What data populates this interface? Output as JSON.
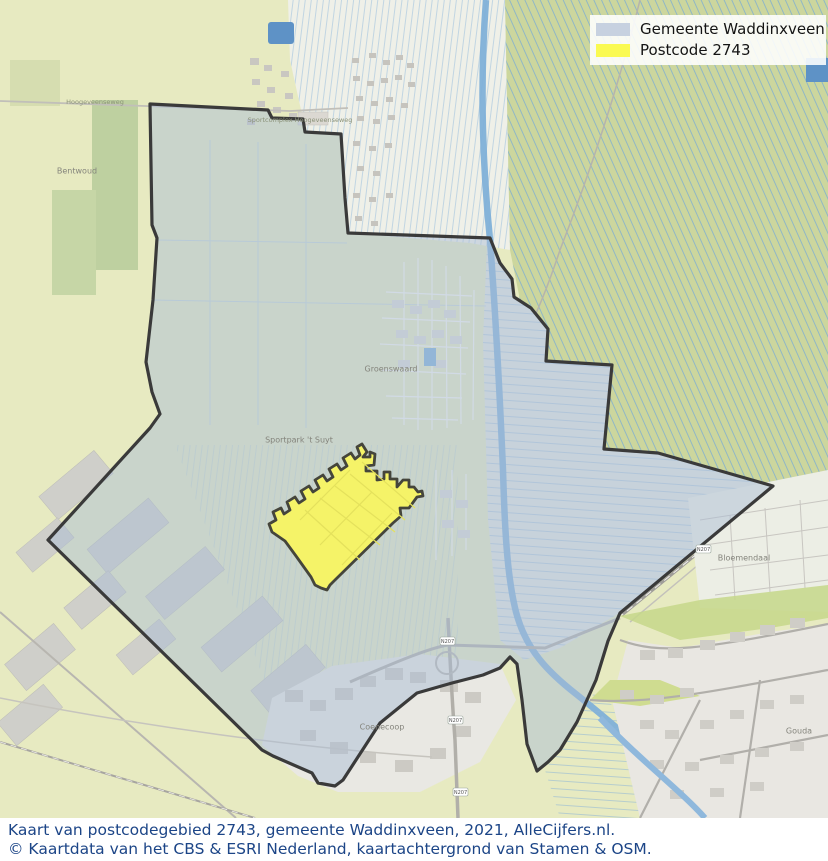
{
  "legend": {
    "items": [
      {
        "label": "Gemeente Waddinxveen",
        "color": "#c7d1e0"
      },
      {
        "label": "Postcode 2743",
        "color": "#fafa52"
      }
    ]
  },
  "caption": {
    "line1": "Kaart van postcodegebied 2743, gemeente Waddinxveen, 2021, AlleCijfers.nl.",
    "line2": "© Kaartdata van het CBS & ESRI Nederland, kaartachtergrond van Stamen & OSM.",
    "color": "#1c4587"
  },
  "colors": {
    "boundary": "#3a3a3a",
    "gemeente_fill": "rgba(170,188,214,0.48)",
    "postcode_fill": "#f5f368",
    "postcode_stroke": "#45453b",
    "water": "#7fb0d8",
    "fields_outside": "#e7eac1",
    "polder_green": "#ccd69d"
  },
  "map": {
    "labels": [
      {
        "text": "Bentwoud"
      },
      {
        "text": "Sportcomplex Hoogeveenseweg"
      },
      {
        "text": "Hoogeveenseweg"
      },
      {
        "text": "Sportpark 't Suyt"
      },
      {
        "text": "Groenswaard"
      },
      {
        "text": "Coenecoop"
      },
      {
        "text": "Bloemendaal"
      },
      {
        "text": "Gouda"
      }
    ],
    "badges": [
      {
        "text": "N207"
      },
      {
        "text": "N207"
      },
      {
        "text": "N207"
      },
      {
        "text": "N207"
      }
    ]
  }
}
